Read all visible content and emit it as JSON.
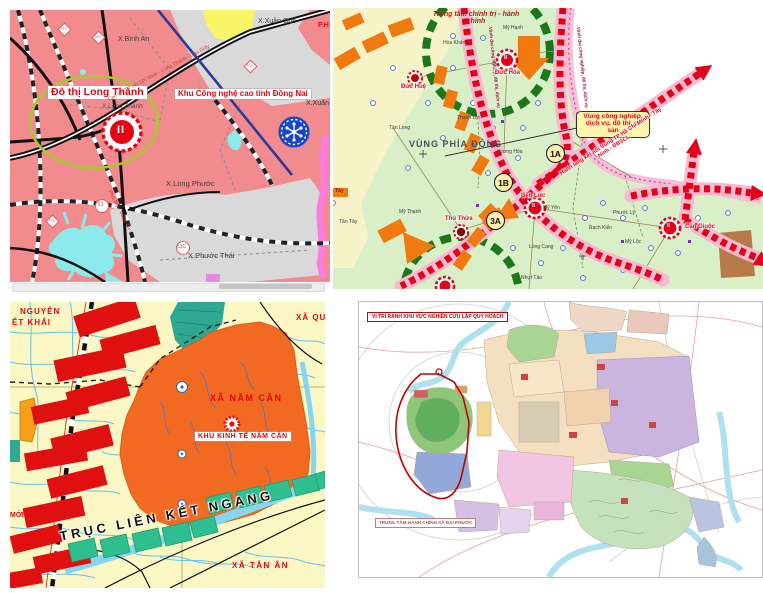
{
  "page": {
    "background": "#ffffff",
    "description": "Four urban-planning map screenshots arranged in a 2x2 grid"
  },
  "palette": {
    "tl_land": "#f28b8d",
    "tl_gray": "#d9d9d9",
    "tl_water": "#8deaea",
    "tl_ellipse": "#a8c832",
    "tr_green": "#d9efc8",
    "tr_yellow": "#f7f3c8",
    "corridor_red": "#e2001a",
    "corridor_pink": "#f9b9cf",
    "orange_arrow": "#f07a10",
    "ring_green": "#1c771c",
    "bl_land": "#faf7c5",
    "bl_zone_orange": "#f26a21",
    "bl_bar_red": "#e01010",
    "bl_parallelogram": "#2fbe8f",
    "br_paper": "#ffffff",
    "highlight_red": "#c00000"
  },
  "tl": {
    "labels": {
      "binh_an": "X.Bình An",
      "xuan_que": "X.Xuân Quế",
      "ph": "P.H",
      "xuan_d": "X.Xuân Đ",
      "do_thi_long_thanh": "Đô thị Long Thành",
      "long_thanh_commune": "X.Long Thành",
      "khu_cnc": "Khu Công nghệ cao tỉnh Đồng Nai",
      "long_phuoc": "X.Long Phước",
      "phuoc_thai": "X.Phước Thái",
      "expressway": "Cao tốc TP Hồ Chí Minh - Long Thành - Dầu Giây",
      "expressway2": "Phú Mỹ - Vũng Tàu",
      "marker_ii": "II",
      "shield_767": "767",
      "shield_769": "769",
      "shield_770": "770",
      "shield_775": "775",
      "shield_51": "51",
      "shield_51c": "51C"
    }
  },
  "tr": {
    "labels": {
      "center_title": "Trung tâm chính trị - hành chính",
      "vung_phia_dong": "VÙNG PHÍA ĐÔNG",
      "callout": "Vùng công nghiệp, dịch vụ, đô thị, di sản",
      "corridor_ring": "Vành đai công nghiệp, đô thị, dịch vụ",
      "corridor_link": "Hành lang kết nối Vùng TP Hồ Chí Minh - Tây Ninh - ĐBSCL",
      "badge_1a": "1A",
      "badge_1b": "1B",
      "badge_3a": "3A",
      "duc_hue": "Đức Huệ",
      "duc_hoa": "Đức Hòa",
      "thu_thua": "Thủ Thừa",
      "ben_luc": "Bến Lức",
      "can_giuoc": "Cần Giuộc",
      "my_hanh": "Mỹ Hạnh",
      "hoa_khanh": "Hòa Khánh",
      "thanh_loi": "Thạnh Lợi",
      "tan_long": "Tân Long",
      "luong_hoa": "Lương Hòa",
      "my_thanh": "Mỹ Thạnh",
      "tan_tay": "Tân Tây",
      "tay_cut": "Tây",
      "my_yen": "Mỹ Yên",
      "phuoc_ly": "Phước Lý",
      "rach_kien": "Rạch Kiến",
      "my_loc": "Mỹ Lộc",
      "long_cang": "Long Cang",
      "nhut_tao": "Nhựt Tảo",
      "marker_ii": "II"
    }
  },
  "bl": {
    "labels": {
      "nguyen_viet_khai_1": "NGUYÊN",
      "nguyen_viet_khai_2": "ỆT KHẢI",
      "xa_qu": "XÃ QU",
      "moi": "MỚI",
      "xa_nam_can": "XÃ NĂM CĂN",
      "khu_kinh_te": "KHU KINH TẾ NĂM CĂN",
      "truc_lien_ket": "TRỤC LIÊN KẾT NGANG",
      "xa_tan_an": "XÃ TÂN ÂN"
    }
  },
  "br": {
    "labels": {
      "vi_tri": "VỊ TRÍ RANH KHU VỰC NGHIÊN CỨU LẬP QUY HOẠCH",
      "trung_tam": "TRUNG TÂM HÀNH CHÍNH XÃ ĐẠI PHƯỚC"
    }
  }
}
